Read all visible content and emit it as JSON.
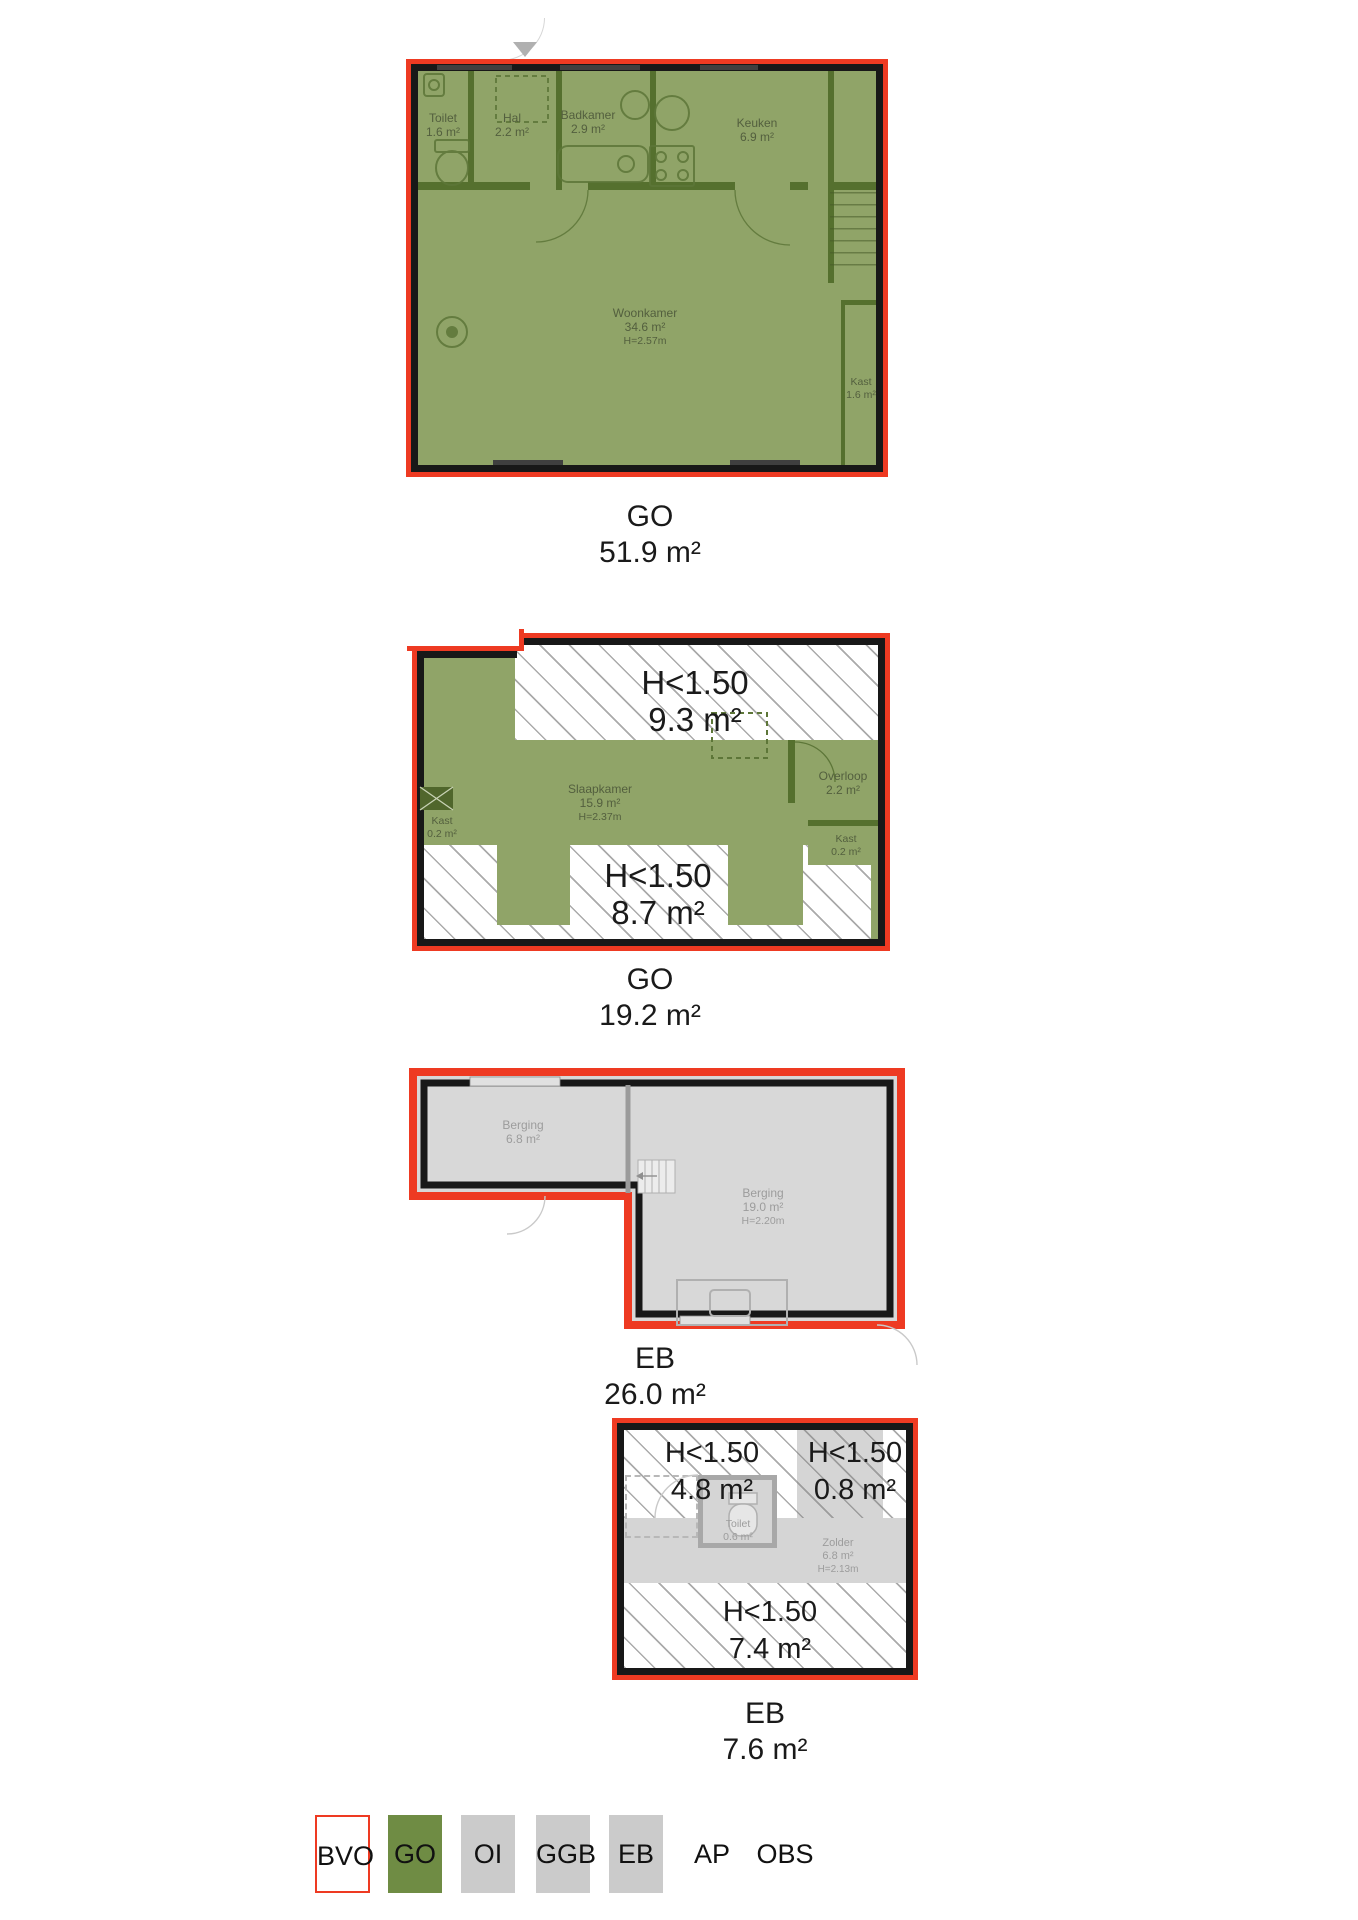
{
  "colors": {
    "outline_red": "#ee3a22",
    "wall_black": "#181818",
    "go_fill_green": "#90a468",
    "legend_green": "#6f8c44",
    "neutral_gray_fill": "#d8d8d8",
    "legend_gray": "#cbcbcb"
  },
  "plans": {
    "p1": {
      "tag": "GO",
      "area": "51.9 m²",
      "rooms": {
        "toilet": {
          "n": "Toilet",
          "a": "1.6 m²"
        },
        "hal": {
          "n": "Hal",
          "a": "2.2 m²"
        },
        "badkamer": {
          "n": "Badkamer",
          "a": "2.9 m²"
        },
        "keuken": {
          "n": "Keuken",
          "a": "6.9 m²"
        },
        "woonkamer": {
          "n": "Woonkamer",
          "a": "34.6 m²",
          "h": "H=2.57m"
        },
        "kast": {
          "n": "Kast",
          "a": "1.6 m²"
        }
      }
    },
    "p2": {
      "tag": "GO",
      "area": "19.2 m²",
      "rooms": {
        "slaapkamer": {
          "n": "Slaapkamer",
          "a": "15.9 m²",
          "h": "H=2.37m"
        },
        "overloop": {
          "n": "Overloop",
          "a": "2.2 m²"
        },
        "kast_left": {
          "n": "Kast",
          "a": "0.2 m²"
        },
        "kast_right": {
          "n": "Kast",
          "a": "0.2 m²"
        }
      },
      "low1": {
        "t": "H<1.50",
        "a": "9.3 m²"
      },
      "low2": {
        "t": "H<1.50",
        "a": "8.7 m²"
      }
    },
    "p3": {
      "tag": "EB",
      "area": "26.0 m²",
      "rooms": {
        "berging1": {
          "n": "Berging",
          "a": "6.8 m²"
        },
        "berging2": {
          "n": "Berging",
          "a": "19.0 m²",
          "h": "H=2.20m"
        }
      }
    },
    "p4": {
      "tag": "EB",
      "area": "7.6 m²",
      "rooms": {
        "toilet": {
          "n": "Toilet",
          "a": "0.6 m²"
        },
        "zolder": {
          "n": "Zolder",
          "a": "6.8 m²",
          "h": "H=2.13m"
        }
      },
      "lowA": {
        "t": "H<1.50",
        "a": "4.8 m²"
      },
      "lowB": {
        "t": "H<1.50",
        "a": "0.8 m²"
      },
      "lowC": {
        "t": "H<1.50",
        "a": "7.4 m²"
      }
    }
  },
  "legend": {
    "bvo": "BVO",
    "go": "GO",
    "oi": "OI",
    "ggb": "GGB",
    "eb": "EB",
    "ap": "AP",
    "obs": "OBS"
  }
}
